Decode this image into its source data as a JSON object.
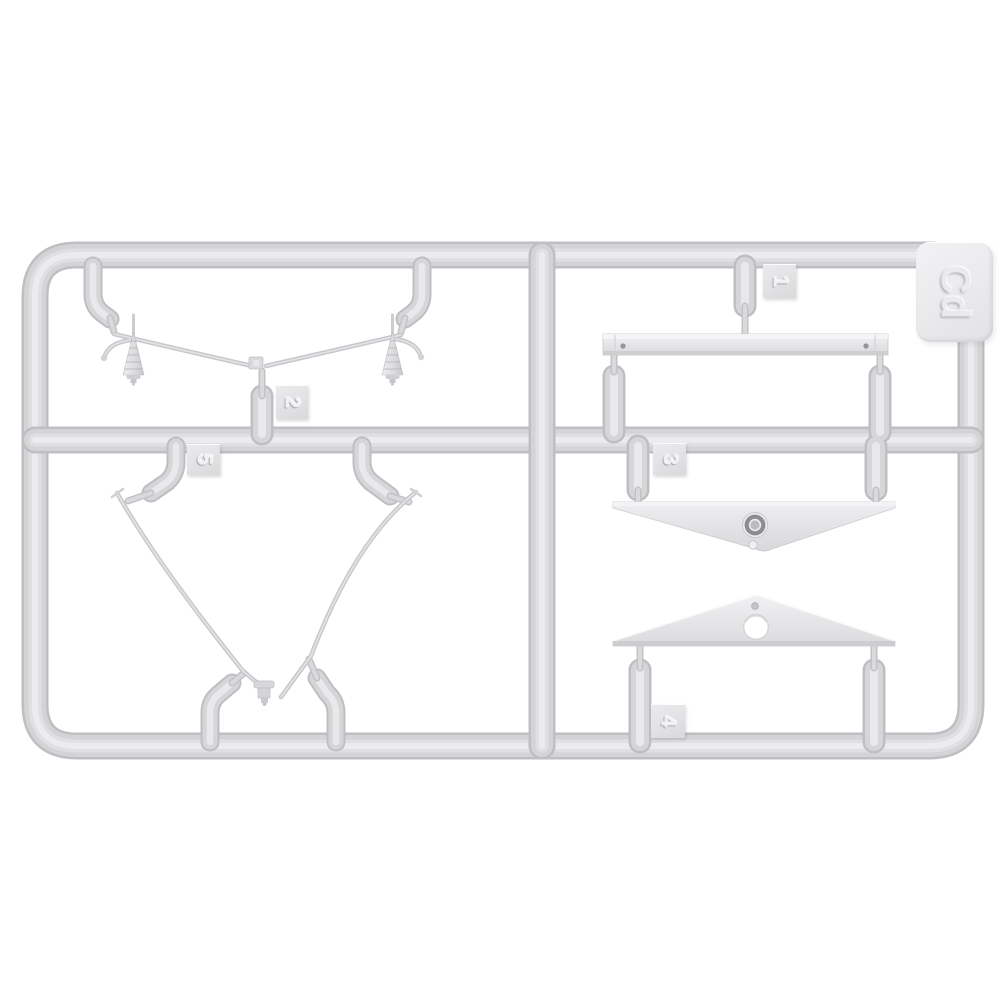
{
  "sprue": {
    "code_label": "Cd",
    "part_tags": {
      "tag1": "1",
      "tag2": "2",
      "tag3": "3",
      "tag4": "4",
      "tag5": "5"
    },
    "colors": {
      "background": "#ffffff",
      "plastic_body": "#d4d4d7",
      "plastic_highlight": "#ececee",
      "plastic_shadow": "#bfbfc3",
      "part_surface": "#ededef",
      "hub_ring": "#8c8c91",
      "pin_hole": "#94949a"
    }
  }
}
